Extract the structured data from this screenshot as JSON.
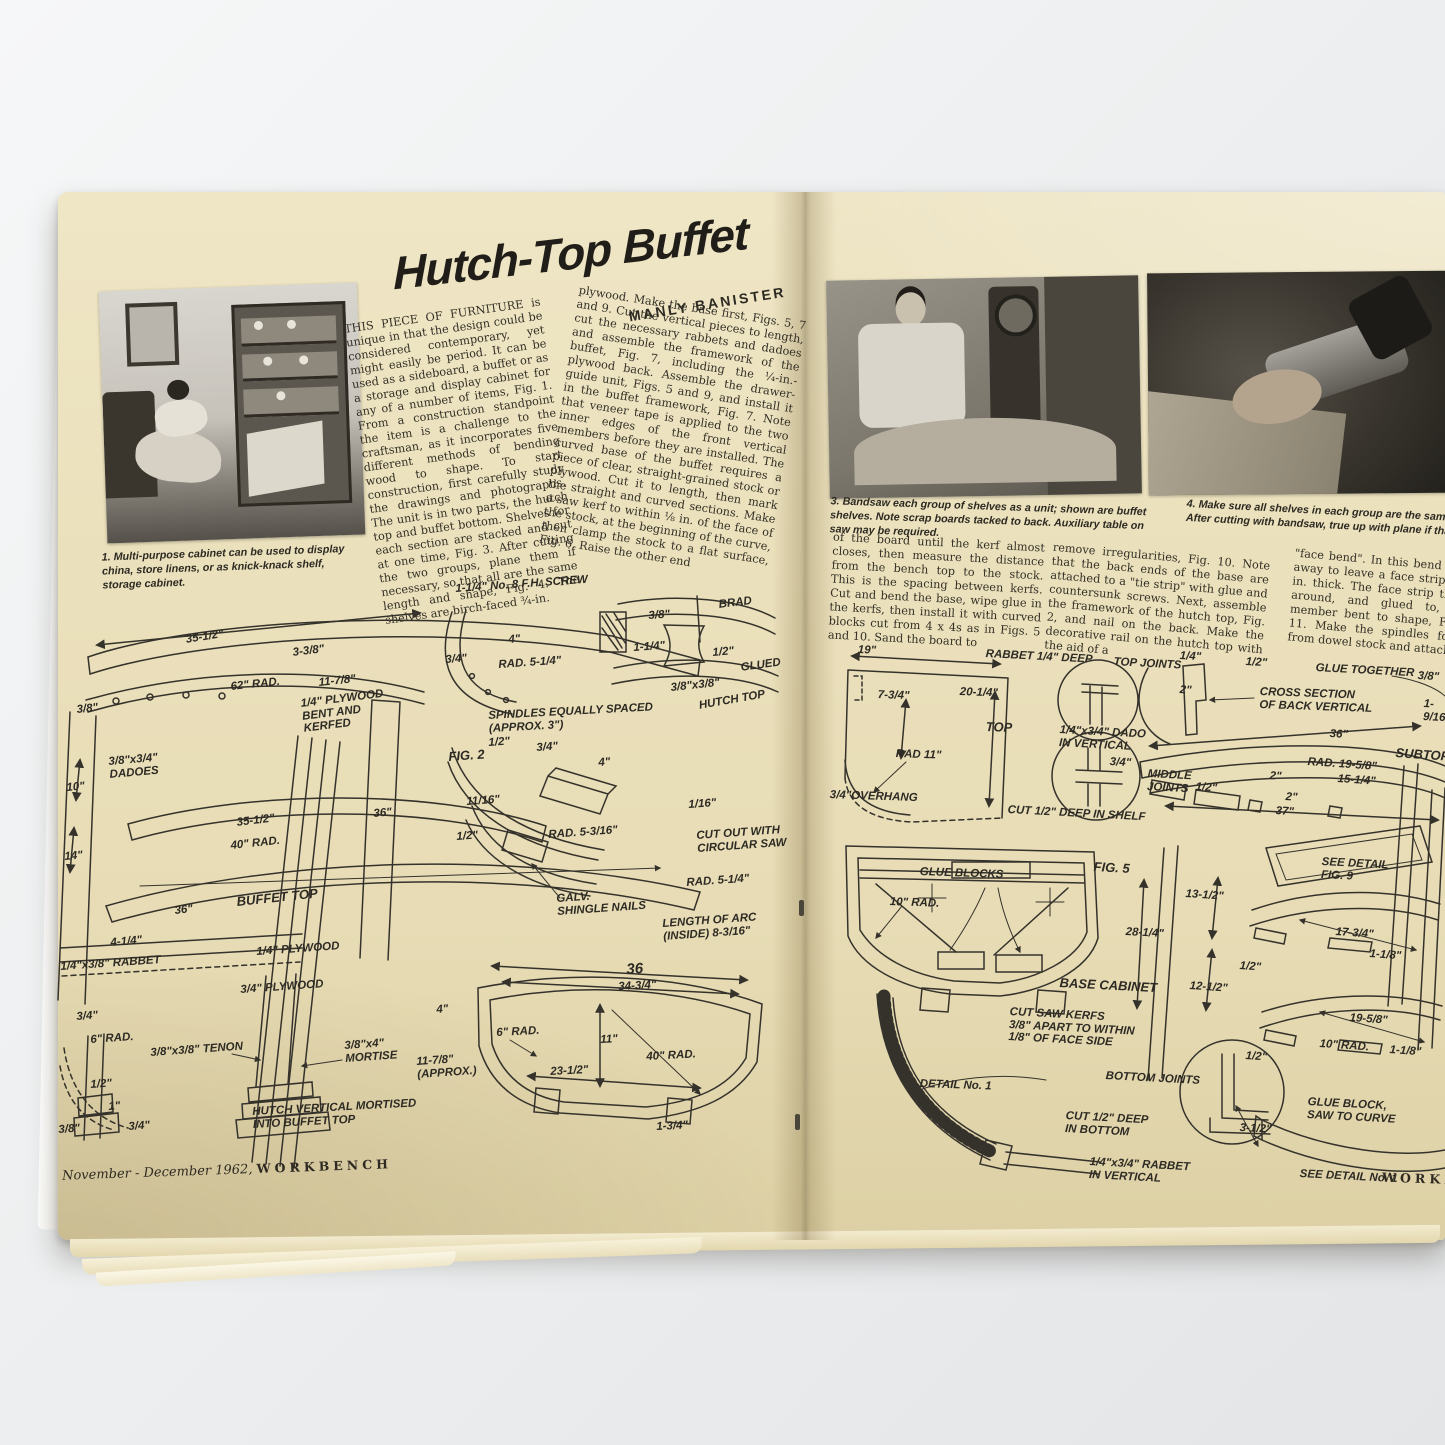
{
  "ui": {
    "paper_color": "#e9dfbc",
    "ink_color": "#2d2a24",
    "backdrop_color": "#eef0f1"
  },
  "header": {
    "title": "Hutch-Top Buffet",
    "byline": "MANLY BANISTER"
  },
  "article": {
    "col1": "THIS PIECE OF FURNITURE is unique in that the design could be considered contemporary, yet might easily be period. It can be used as a sideboard, a buffet or as a storage and display cabinet for any of a number of items, Fig. 1. From a construction standpoint the item is a challenge to the craftsman, as it incorporates five different methods of bending wood to shape.  To start construction, first carefully study the drawings and photographs. The unit is in two parts, the hutch top and buffet bottom. Shelves for each section are stacked and cut at one time, Fig. 3. After cutting the two groups, plane them if necessary, so that all are the same length and shape, Fig. 4. The shelves are birch-faced ¾-in.",
    "col2": "plywood. Make the base first, Figs. 5, 7 and 9. Cut the vertical pieces to length, cut the necessary rabbets and dadoes and assemble the framework of the buffet, Fig. 7, including the ¼-in.-plywood back. Assemble the drawer-guide unit, Figs. 5 and 9, and install it in the buffet framework, Fig. 7. Note that veneer tape is applied to the two inner edges of the front vertical members before they are installed. The curved base of the buffet requires a piece of clear, straight-grained stock or plywood. Cut it to length, then mark the straight and curved sections. Make a saw kerf to within ⅛ in. of the face of the stock, at the beginning of the curve, then clamp the stock to a flat surface, Fig. 6. Raise the other end",
    "col3": "of the board until the kerf almost closes, then measure the distance from the bench top to the stock. This is the spacing between kerfs. Cut and bend the base, wipe glue in the kerfs, then install it with curved blocks cut from 4 x 4s as in Figs. 5 and 10. Sand the board to",
    "col4": "remove irregularities, Fig. 10. Note that the back ends of the base are attached to a \"tie strip\" with glue and countersunk screws.  Next, assemble the framework of the hutch top, Fig. 2, and nail on the back. Make the decorative rail on the hutch top with the aid of a",
    "col5": "\"face bend\". In this bend stock is cut away to leave a face strip about 1/16 in. thick. The face strip then is bent around, and glued to, a curved member bent to shape, Figs. 2 and 11. Make the spindles for the rail from dowel stock and attach"
  },
  "captions": {
    "fig1": "1. Multi-purpose cabinet can be used to display china, store linens, or as knick-knack shelf, storage cabinet.",
    "fig3": "3. Bandsaw each group of shelves as a unit; shown are buffet shelves. Note scrap boards tacked to back. Auxiliary table on saw may be required.",
    "fig4": "4. Make sure all shelves in each group are the same shape and size. After cutting with bandsaw, true up with plane if that is necessary."
  },
  "footers": {
    "left_issue": "November - December 1962,",
    "left_brand": "WORKBENCH",
    "right_brand": "WORKBENCH"
  },
  "left_diagram": {
    "labels": [
      {
        "t": "1-1/4\" No. 8 F.H. SCREW",
        "x": 455,
        "y": 583,
        "r": -4
      },
      {
        "t": "3/8\"",
        "x": 648,
        "y": 610,
        "r": -4
      },
      {
        "t": "35-1/2\"",
        "x": 185,
        "y": 634,
        "r": -9
      },
      {
        "t": "3-3/8\"",
        "x": 292,
        "y": 647,
        "r": -7
      },
      {
        "t": "BRAD",
        "x": 718,
        "y": 599,
        "r": -7
      },
      {
        "t": "3/4\"",
        "x": 445,
        "y": 654,
        "r": -4
      },
      {
        "t": "4\"",
        "x": 508,
        "y": 634,
        "r": -4
      },
      {
        "t": "1-1/4\"",
        "x": 633,
        "y": 642,
        "r": -4
      },
      {
        "t": "1/2\"",
        "x": 712,
        "y": 647,
        "r": -5
      },
      {
        "t": "62\" RAD.",
        "x": 230,
        "y": 681,
        "r": -6
      },
      {
        "t": "11-7/8\"",
        "x": 318,
        "y": 677,
        "r": -6
      },
      {
        "t": "RAD. 5-1/4\"",
        "x": 498,
        "y": 659,
        "r": -4
      },
      {
        "t": "GLUED",
        "x": 740,
        "y": 662,
        "r": -8
      },
      {
        "t": "3/8\"x3/8\"",
        "x": 670,
        "y": 682,
        "r": -6
      },
      {
        "t": "3/8\"",
        "x": 76,
        "y": 704,
        "r": -6
      },
      {
        "t": "HUTCH TOP",
        "x": 698,
        "y": 700,
        "r": -10
      },
      {
        "t": "1/4\" PLYWOOD\nBENT AND\nKERFED",
        "x": 300,
        "y": 698,
        "r": -7
      },
      {
        "t": "SPINDLES EQUALLY SPACED\n(APPROX. 3\")",
        "x": 488,
        "y": 710,
        "r": -3
      },
      {
        "t": "1/2\"",
        "x": 488,
        "y": 737,
        "r": -4
      },
      {
        "t": "3/4\"",
        "x": 536,
        "y": 742,
        "r": -4
      },
      {
        "t": "3/8\"x3/4\"\nDADOES",
        "x": 108,
        "y": 756,
        "r": -5
      },
      {
        "t": "10\"",
        "x": 66,
        "y": 782,
        "r": -5
      },
      {
        "t": "FIG. 2",
        "x": 448,
        "y": 750,
        "r": -4,
        "b": 1
      },
      {
        "t": "4\"",
        "x": 598,
        "y": 757,
        "r": -4
      },
      {
        "t": "36\"",
        "x": 373,
        "y": 808,
        "r": -5
      },
      {
        "t": "11/16\"",
        "x": 466,
        "y": 796,
        "r": -4
      },
      {
        "t": "1/16\"",
        "x": 688,
        "y": 799,
        "r": -4
      },
      {
        "t": "1/2\"",
        "x": 456,
        "y": 831,
        "r": -4
      },
      {
        "t": "RAD. 5-3/16\"",
        "x": 548,
        "y": 829,
        "r": -4
      },
      {
        "t": "35-1/2\"",
        "x": 236,
        "y": 817,
        "r": -7
      },
      {
        "t": "CUT OUT WITH\nCIRCULAR SAW",
        "x": 696,
        "y": 830,
        "r": -4
      },
      {
        "t": "40\" RAD.",
        "x": 230,
        "y": 840,
        "r": -6
      },
      {
        "t": "14\"",
        "x": 64,
        "y": 851,
        "r": -5
      },
      {
        "t": "RAD. 5-1/4\"",
        "x": 686,
        "y": 877,
        "r": -4
      },
      {
        "t": "BUFFET TOP",
        "x": 236,
        "y": 895,
        "r": -6,
        "b": 1
      },
      {
        "t": "36\"",
        "x": 174,
        "y": 905,
        "r": -6
      },
      {
        "t": "GALV.\nSHINGLE NAILS",
        "x": 556,
        "y": 893,
        "r": -4
      },
      {
        "t": "LENGTH OF ARC\n(INSIDE) 8-3/16\"",
        "x": 662,
        "y": 918,
        "r": -4
      },
      {
        "t": "1/4\" PLYWOOD",
        "x": 256,
        "y": 946,
        "r": -4
      },
      {
        "t": "4-1/4\"",
        "x": 110,
        "y": 937,
        "r": -5
      },
      {
        "t": "1/4\"x3/8\" RABBET",
        "x": 60,
        "y": 961,
        "r": -4
      },
      {
        "t": "3/4\" PLYWOOD",
        "x": 240,
        "y": 984,
        "r": -4
      },
      {
        "t": "36",
        "x": 626,
        "y": 962,
        "r": -3,
        "s": 15
      },
      {
        "t": "34-3/4\"",
        "x": 618,
        "y": 981,
        "r": -3
      },
      {
        "t": "3/4\"",
        "x": 76,
        "y": 1011,
        "r": -4
      },
      {
        "t": "4\"",
        "x": 436,
        "y": 1004,
        "r": -4
      },
      {
        "t": "6\" RAD.",
        "x": 90,
        "y": 1034,
        "r": -4
      },
      {
        "t": "6\" RAD.",
        "x": 496,
        "y": 1027,
        "r": -3
      },
      {
        "t": "11\"",
        "x": 600,
        "y": 1034,
        "r": -3
      },
      {
        "t": "3/8\"x3/8\" TENON",
        "x": 150,
        "y": 1047,
        "r": -4
      },
      {
        "t": "3/8\"x4\"\nMORTISE",
        "x": 344,
        "y": 1040,
        "r": -4
      },
      {
        "t": "40\" RAD.",
        "x": 646,
        "y": 1051,
        "r": -3
      },
      {
        "t": "11-7/8\"\n(APPROX.)",
        "x": 416,
        "y": 1056,
        "r": -4
      },
      {
        "t": "23-1/2\"",
        "x": 550,
        "y": 1066,
        "r": -3
      },
      {
        "t": "1/2\"",
        "x": 90,
        "y": 1079,
        "r": -4
      },
      {
        "t": "1\"",
        "x": 108,
        "y": 1101,
        "r": -4
      },
      {
        "t": "3/8\"",
        "x": 58,
        "y": 1124,
        "r": -4
      },
      {
        "t": "3/4\"",
        "x": 128,
        "y": 1121,
        "r": -4
      },
      {
        "t": "HUTCH VERTICAL MORTISED\nINTO BUFFET TOP",
        "x": 252,
        "y": 1106,
        "r": -3
      },
      {
        "t": "1-3/4\"",
        "x": 656,
        "y": 1121,
        "r": -3
      }
    ]
  },
  "right_diagram": {
    "labels": [
      {
        "t": "19\"",
        "x": 858,
        "y": 644,
        "r": 2
      },
      {
        "t": "RABBET 1/4\" DEEP",
        "x": 986,
        "y": 648,
        "r": 3
      },
      {
        "t": "TOP JOINTS",
        "x": 1114,
        "y": 656,
        "r": 3
      },
      {
        "t": "1/4\"",
        "x": 1180,
        "y": 650,
        "r": 3
      },
      {
        "t": "1/2\"",
        "x": 1246,
        "y": 656,
        "r": 3
      },
      {
        "t": "GLUE TOGETHER",
        "x": 1316,
        "y": 662,
        "r": 3
      },
      {
        "t": "3/8\"",
        "x": 1418,
        "y": 670,
        "r": 3
      },
      {
        "t": "7-3/4\"",
        "x": 878,
        "y": 689,
        "r": 2
      },
      {
        "t": "20-1/4\"",
        "x": 960,
        "y": 686,
        "r": 2
      },
      {
        "t": "2\"",
        "x": 1180,
        "y": 684,
        "r": 3
      },
      {
        "t": "CROSS SECTION\nOF BACK VERTICAL",
        "x": 1260,
        "y": 686,
        "r": 2
      },
      {
        "t": "1-9/16\"",
        "x": 1424,
        "y": 698,
        "r": 3
      },
      {
        "t": "TOP",
        "x": 986,
        "y": 720,
        "r": 2,
        "b": 1
      },
      {
        "t": "1/4\"x3/4\" DADO\nIN VERTICAL",
        "x": 1060,
        "y": 724,
        "r": 3
      },
      {
        "t": "36\"",
        "x": 1330,
        "y": 728,
        "r": 3
      },
      {
        "t": "RAD 11\"",
        "x": 896,
        "y": 748,
        "r": 2
      },
      {
        "t": "3/4\"",
        "x": 1110,
        "y": 756,
        "r": 3
      },
      {
        "t": "MIDDLE\nJOINTS",
        "x": 1148,
        "y": 768,
        "r": 3
      },
      {
        "t": "RAD. 19-5/8\"",
        "x": 1308,
        "y": 756,
        "r": 4
      },
      {
        "t": "SUBTOP",
        "x": 1396,
        "y": 746,
        "r": 4,
        "b": 1
      },
      {
        "t": "2\"",
        "x": 1270,
        "y": 770,
        "r": 4
      },
      {
        "t": "15-1/4\"",
        "x": 1338,
        "y": 773,
        "r": 4
      },
      {
        "t": "3/4\"OVERHANG",
        "x": 830,
        "y": 789,
        "r": 2
      },
      {
        "t": "1/2\"",
        "x": 1196,
        "y": 781,
        "r": 4
      },
      {
        "t": "2\"",
        "x": 1286,
        "y": 791,
        "r": 4
      },
      {
        "t": "CUT 1/2\" DEEP IN SHELF",
        "x": 1008,
        "y": 804,
        "r": 3
      },
      {
        "t": "37\"",
        "x": 1276,
        "y": 805,
        "r": 4
      },
      {
        "t": "GLUE BLOCKS",
        "x": 920,
        "y": 866,
        "r": 2
      },
      {
        "t": "FIG. 5",
        "x": 1094,
        "y": 860,
        "r": 3,
        "b": 1
      },
      {
        "t": "SEE DETAIL\nFIG. 9",
        "x": 1322,
        "y": 856,
        "r": 3
      },
      {
        "t": "10\" RAD.",
        "x": 890,
        "y": 896,
        "r": 2
      },
      {
        "t": "13-1/2\"",
        "x": 1186,
        "y": 888,
        "r": 4
      },
      {
        "t": "28-1/4\"",
        "x": 1126,
        "y": 926,
        "r": 3
      },
      {
        "t": "17-3/4\"",
        "x": 1336,
        "y": 926,
        "r": 4
      },
      {
        "t": "1/2\"",
        "x": 1240,
        "y": 960,
        "r": 4
      },
      {
        "t": "1-1/8\"",
        "x": 1370,
        "y": 948,
        "r": 4
      },
      {
        "t": "BASE CABINET",
        "x": 1060,
        "y": 976,
        "r": 3,
        "b": 1
      },
      {
        "t": "12-1/2\"",
        "x": 1190,
        "y": 980,
        "r": 4
      },
      {
        "t": "CUT SAW KERFS\n3/8\" APART TO WITHIN\n1/8\" OF FACE SIDE",
        "x": 1010,
        "y": 1006,
        "r": 3
      },
      {
        "t": "19-5/8\"",
        "x": 1350,
        "y": 1012,
        "r": 4
      },
      {
        "t": "10\" RAD.",
        "x": 1320,
        "y": 1038,
        "r": 4
      },
      {
        "t": "1/2\"",
        "x": 1246,
        "y": 1050,
        "r": 4
      },
      {
        "t": "1-1/8\"",
        "x": 1390,
        "y": 1044,
        "r": 4
      },
      {
        "t": "DETAIL No. 1",
        "x": 920,
        "y": 1078,
        "r": 2
      },
      {
        "t": "BOTTOM JOINTS",
        "x": 1106,
        "y": 1070,
        "r": 3
      },
      {
        "t": "CUT 1/2\" DEEP\nIN BOTTOM",
        "x": 1066,
        "y": 1110,
        "r": 3
      },
      {
        "t": "GLUE BLOCK,\nSAW TO CURVE",
        "x": 1308,
        "y": 1096,
        "r": 3
      },
      {
        "t": "3-1/2\"",
        "x": 1240,
        "y": 1122,
        "r": 3
      },
      {
        "t": "1/4\"x3/4\" RABBET\nIN VERTICAL",
        "x": 1090,
        "y": 1156,
        "r": 3
      },
      {
        "t": "SEE DETAIL No. 1",
        "x": 1300,
        "y": 1168,
        "r": 3
      }
    ]
  }
}
